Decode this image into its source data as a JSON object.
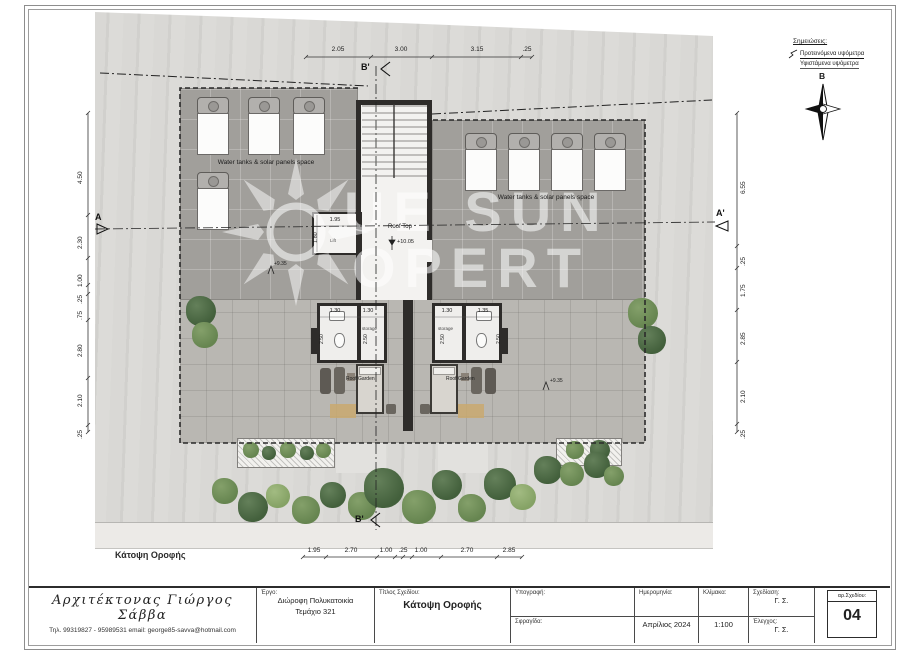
{
  "sheet": {
    "drawing_label": "Κάτοψη Οροφής"
  },
  "watermark": {
    "line1": "UE SUN",
    "line2": "OPERT"
  },
  "legend": {
    "title": "Σημειώσεις:",
    "proposed": "Προτεινόμενα υψόμετρα",
    "existing": "Υφιστάμενα υψόμετρα",
    "north": "B"
  },
  "sections": {
    "a": "A",
    "a_prime": "A'",
    "b_top": "B'",
    "b_bottom": "B'"
  },
  "dims": {
    "top": [
      "2.05",
      "3.00",
      "3.15",
      ".25"
    ],
    "left": [
      "4.50",
      "2.30",
      "1.00",
      ".25",
      ".75",
      "2.80",
      "2.10",
      ".25"
    ],
    "right": [
      "6.55",
      ".25",
      "1.75",
      "2.85",
      "2.10",
      ".25"
    ],
    "bottom": [
      "1.95",
      "2.70",
      "1.00",
      ".25",
      "1.00",
      "2.70",
      "2.85"
    ]
  },
  "plan": {
    "water_tanks_label": "Water tanks & solar panels  space",
    "roof_top": "Roof Top",
    "roof_top_level": "+10.05",
    "level": "+9.35",
    "lift": "Lift",
    "lift_w": "1.95",
    "lift_h": "1.80",
    "unit_dims": [
      "1.30",
      "1.30",
      "1.30",
      "1.35"
    ],
    "unit_h": "2.50",
    "storage": "storage",
    "roof_garden": "Roof Garden"
  },
  "titleblock": {
    "architect_name": "Αρχιτέκτονας   Γιώργος Σάββα",
    "architect_contact": "Τηλ. 99319827 - 95989531 email: george85-savva@hotmail.com",
    "project_label": "Έργο:",
    "project_line1": "Διώροφη Πολυκατοικία",
    "project_line2": "Τεμάχιο  321",
    "title_label": "Τίτλος Σχεδίου:",
    "title_value": "Κάτοψη Οροφής",
    "signature_label": "Υπογραφή:",
    "stamp_label": "Σφραγίδα:",
    "date_label": "Ημερομηνία:",
    "date_value": "Απρίλιος 2024",
    "scale_label": "Κλίμακα:",
    "scale_value": "1:100",
    "drawn_label": "Σχεδίαση:",
    "drawn_value": "Γ. Σ.",
    "checked_label": "Έλεγχος:",
    "checked_value": "Γ. Σ.",
    "number_label": "αρ.Σχεδίου:",
    "number_value": "04"
  },
  "colors": {
    "site": "#d6d5d2",
    "roof": "#a19f9b",
    "paving": "#b9b7b2",
    "wall": "#2e2c2a",
    "green_dark": "#43603c",
    "green_mid": "#668550"
  }
}
